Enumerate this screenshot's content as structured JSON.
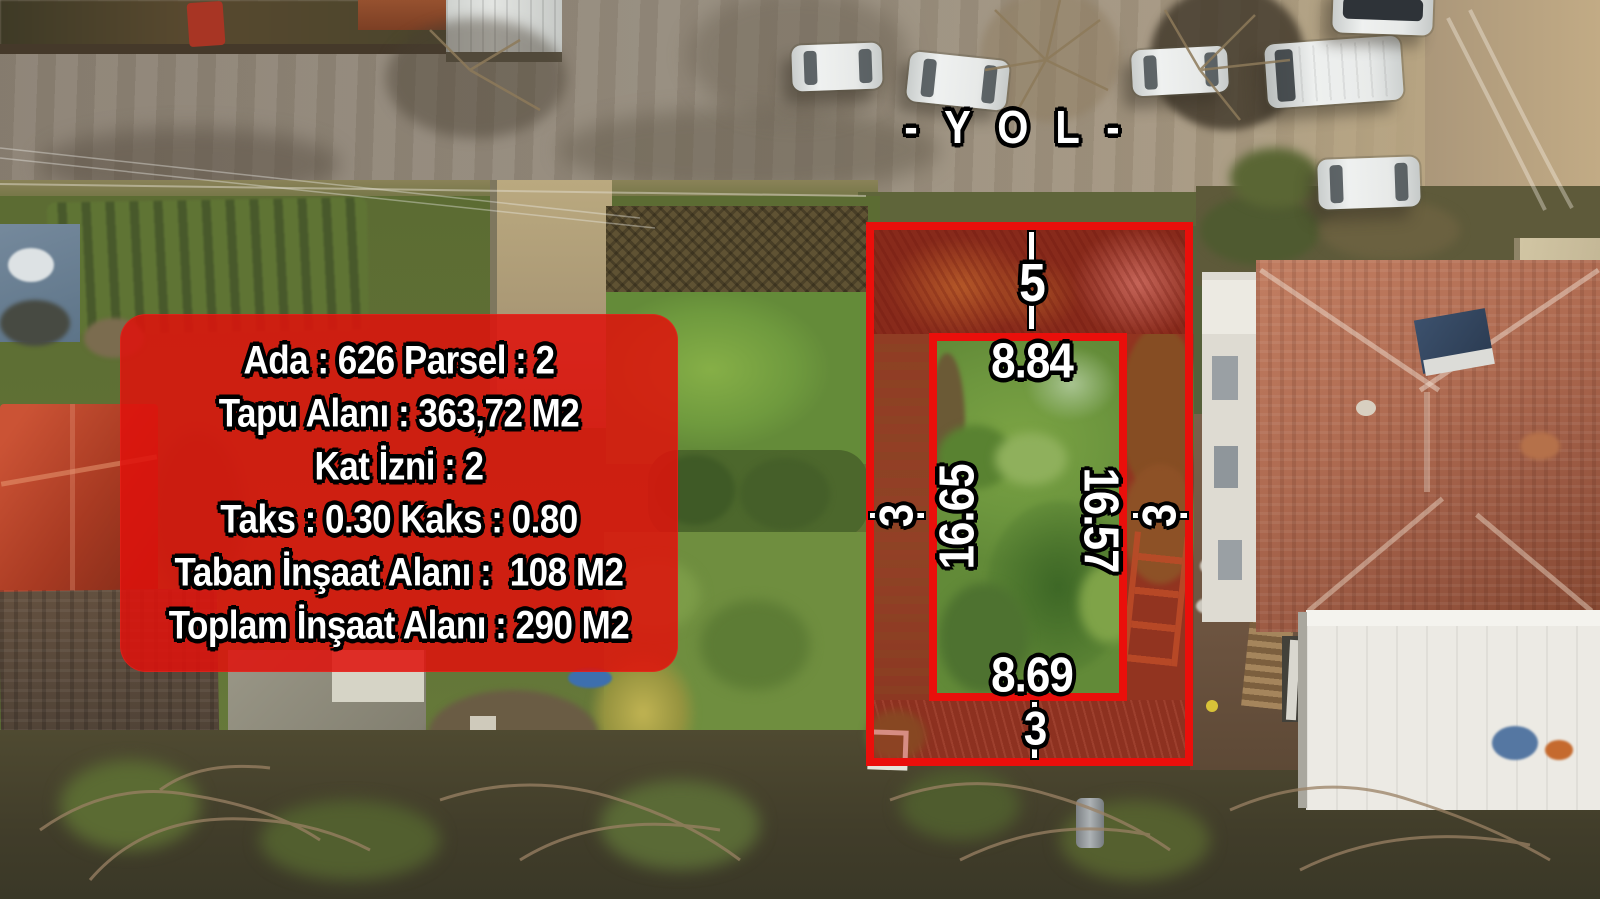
{
  "road_label": "- Y O L -",
  "info_box": {
    "lines": [
      "Ada : 626 Parsel : 2",
      "Tapu Alanı : 363,72 M2",
      "Kat İzni : 2",
      "Taks : 0.30 Kaks : 0.80",
      "Taban İnşaat Alanı :  108 M2",
      "Toplam İnşaat Alanı : 290 M2"
    ]
  },
  "parcel_annotations": {
    "outer_top": "5",
    "inner_top": "8.84",
    "outer_left": "3",
    "inner_left": "16.65",
    "inner_right": "16.57",
    "outer_right": "3",
    "inner_bottom": "8.69",
    "outer_bottom": "3"
  },
  "colors": {
    "annotation_red": "#ea0f0b",
    "info_box_red": "rgba(224,18,12,0.86)",
    "parcel_tint": "rgba(196,22,12,0.42)"
  }
}
